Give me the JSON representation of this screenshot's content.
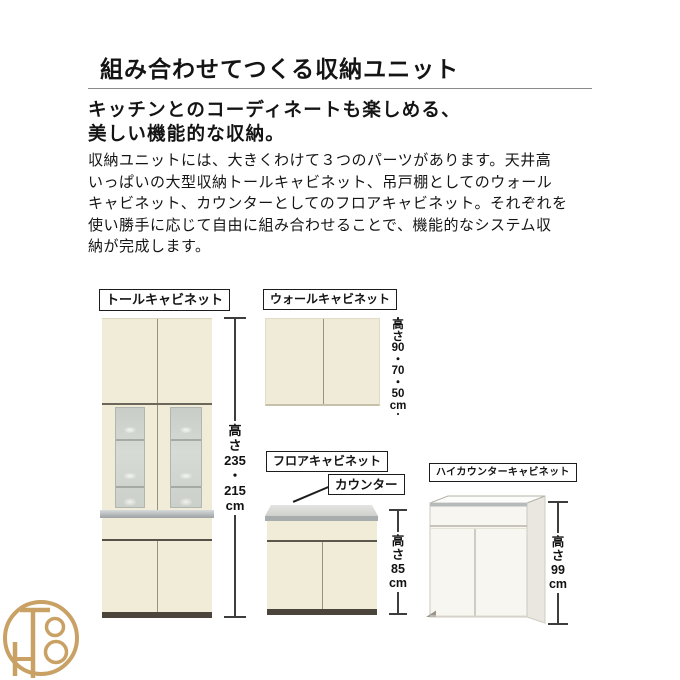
{
  "page": {
    "title": "組み合わせてつくる収納ユニット",
    "subtitle": "キッチンとのコーディネートも楽しめる、\n美しい機能的な収納。",
    "body": "収納ユニットには、大きくわけて３つのパーツがあります。天井高\nいっぱいの大型収納トールキャビネット、吊戸棚としてのウォール\nキャビネット、カウンターとしてのフロアキャビネット。それぞれを\n使い勝手に応じて自由に組み合わせることで、機能的なシステム収\n納が完成します。"
  },
  "cabinets": {
    "tall": {
      "label": "トールキャビネット",
      "height_note": "高さ\n235\n・\n215\ncm"
    },
    "wall": {
      "label": "ウォールキャビネット",
      "height_note": "高さ\n90\n・\n70\n・\n50\ncm"
    },
    "floor": {
      "label": "フロアキャビネット",
      "counter_label": "カウンター",
      "height_note": "高さ\n85\ncm"
    },
    "high_counter": {
      "label": "ハイカウンターキャビネット",
      "height_note": "高さ\n99\ncm"
    }
  },
  "watermark": {
    "monogram": "TH8"
  },
  "colors": {
    "cabinet_cream": "#f1ecd8",
    "glass_gray": "#ccd0ca",
    "counter_gray": "#a8acad",
    "base_dark": "#4a443a",
    "logo_gold": "#c9a164"
  }
}
